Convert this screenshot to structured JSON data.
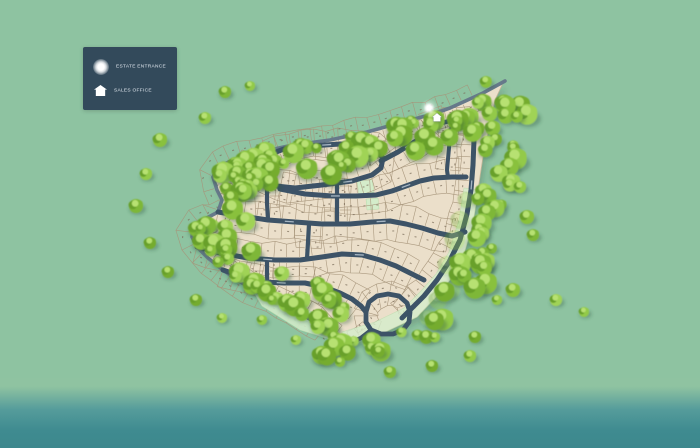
{
  "legend": {
    "items": [
      {
        "label": "ESTATE ENTRANCE",
        "icon": "glow-circle-icon"
      },
      {
        "label": "SALES OFFICE",
        "icon": "house-icon"
      }
    ]
  },
  "map": {
    "markers": [
      {
        "name": "estate-entrance-marker",
        "type": "glow",
        "x": 429,
        "y": 108
      },
      {
        "name": "sales-office-marker",
        "type": "house",
        "x": 437,
        "y": 117
      }
    ]
  },
  "palette": {
    "background": "#8ec3a1",
    "water_top": "#8fc3a1",
    "water_mid": "#559c9b",
    "water_deep": "#3f8b90",
    "estate_fill": "#ebdfca",
    "estate_edge": "#c3b496",
    "lot_line": "#a6957a",
    "lot_number_mark": "#7c6e5b",
    "road_inner": "#3d5367",
    "road_perimeter": "#66798a",
    "road_label": "rgba(176,192,205,0.9)",
    "open_space": "#d4ecca",
    "open_space_edge": "#b9dcab",
    "legend_bg": "#334a5b",
    "legend_text": "#e3eaf1",
    "tree_greens": [
      "#74ac2e",
      "#7eb737",
      "#89c13e",
      "#93ca48",
      "#a0d356"
    ],
    "tree_lobe_dark": "#68a02c",
    "tree_highlight": "#b7e172",
    "tree_shadow": "rgba(47,86,58,0.35)",
    "marker_white": "#ffffff"
  }
}
